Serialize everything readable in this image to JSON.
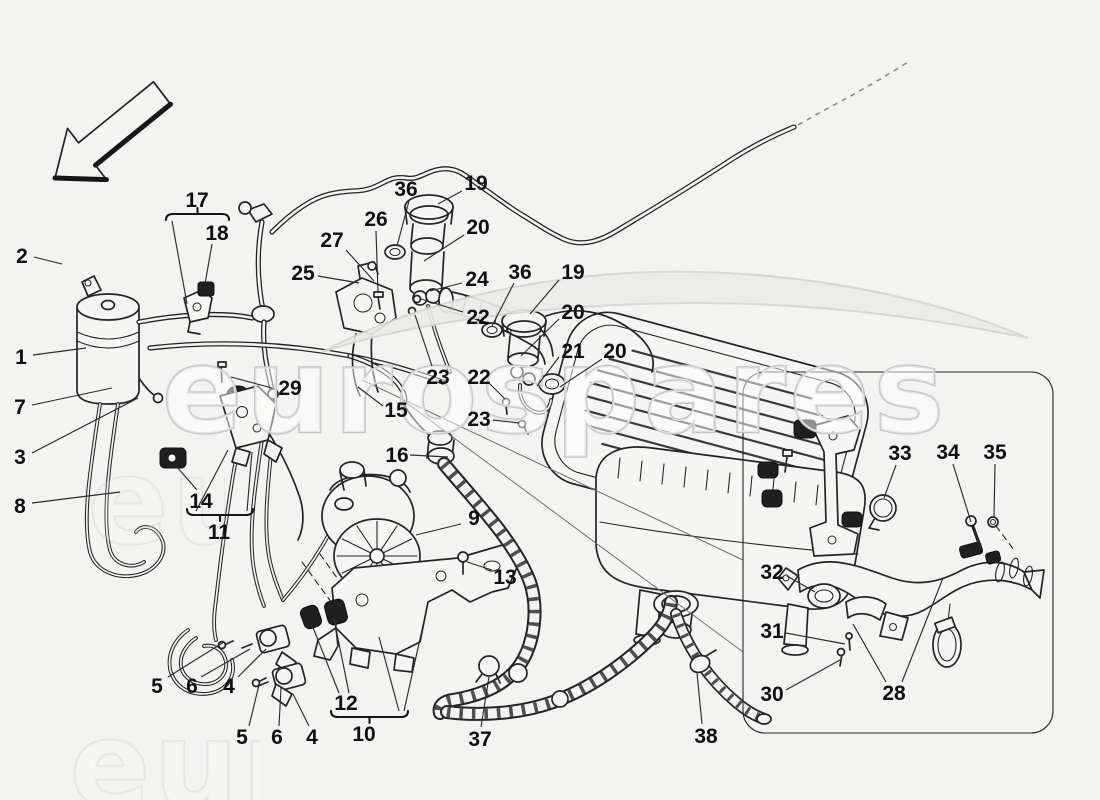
{
  "canvas": {
    "width": 1100,
    "height": 800,
    "paper_color": "#f3f3f1",
    "line_color": "#242424",
    "label_color": "#101010"
  },
  "watermark": {
    "text": "eurospares",
    "outline_color": "#c6c6c6",
    "fill_color": "#ffffff",
    "swoosh_color": "#ececea"
  },
  "direction_arrow": {
    "present": true,
    "points_to": "front-left"
  },
  "inset_box": {
    "x": 743,
    "y": 372,
    "width": 310,
    "height": 361
  },
  "callouts": [
    {
      "n": "2",
      "x": 22,
      "y": 256,
      "leaders": [
        [
          34,
          257,
          62,
          264
        ]
      ]
    },
    {
      "n": "1",
      "x": 21,
      "y": 357,
      "leaders": [
        [
          33,
          355,
          86,
          348
        ]
      ]
    },
    {
      "n": "7",
      "x": 20,
      "y": 407,
      "leaders": [
        [
          32,
          405,
          112,
          388
        ]
      ]
    },
    {
      "n": "3",
      "x": 20,
      "y": 457,
      "leaders": [
        [
          32,
          453,
          138,
          398
        ]
      ]
    },
    {
      "n": "8",
      "x": 20,
      "y": 506,
      "leaders": [
        [
          32,
          503,
          120,
          492
        ]
      ]
    },
    {
      "n": "17",
      "x": 197,
      "y": 200,
      "leaders": [
        [
          172,
          221,
          187,
          304
        ]
      ]
    },
    {
      "n": "18",
      "x": 217,
      "y": 233,
      "leaders": [
        [
          212,
          244,
          205,
          284
        ]
      ]
    },
    {
      "n": "29",
      "x": 290,
      "y": 388,
      "leaders": [
        [
          272,
          388,
          231,
          377
        ]
      ]
    },
    {
      "n": "14",
      "x": 201,
      "y": 501,
      "leaders": [
        [
          197,
          490,
          176,
          466
        ]
      ]
    },
    {
      "n": "11",
      "x": 219,
      "y": 532,
      "leaders": [
        [
          196,
          511,
          228,
          450
        ],
        [
          247,
          511,
          252,
          452
        ]
      ]
    },
    {
      "n": "5",
      "x": 157,
      "y": 686,
      "leaders": [
        [
          168,
          677,
          224,
          642
        ]
      ]
    },
    {
      "n": "6",
      "x": 192,
      "y": 686,
      "leaders": [
        [
          201,
          677,
          250,
          649
        ]
      ]
    },
    {
      "n": "4",
      "x": 229,
      "y": 686,
      "leaders": [
        [
          238,
          677,
          266,
          649
        ]
      ]
    },
    {
      "n": "5",
      "x": 242,
      "y": 737,
      "leaders": [
        [
          249,
          726,
          259,
          685
        ]
      ]
    },
    {
      "n": "6",
      "x": 277,
      "y": 737,
      "leaders": [
        [
          279,
          726,
          281,
          688
        ]
      ]
    },
    {
      "n": "4",
      "x": 312,
      "y": 737,
      "leaders": [
        [
          309,
          726,
          293,
          694
        ]
      ]
    },
    {
      "n": "12",
      "x": 346,
      "y": 703,
      "leaders": [
        [
          339,
          693,
          312,
          625
        ],
        [
          349,
          693,
          334,
          619
        ]
      ]
    },
    {
      "n": "10",
      "x": 364,
      "y": 734,
      "leaders": [
        [
          399,
          711,
          379,
          637
        ],
        [
          404,
          711,
          424,
          621
        ]
      ]
    },
    {
      "n": "15",
      "x": 396,
      "y": 410,
      "leaders": [
        [
          383,
          406,
          358,
          387
        ]
      ]
    },
    {
      "n": "16",
      "x": 397,
      "y": 455,
      "leaders": [
        [
          410,
          455,
          448,
          457
        ]
      ]
    },
    {
      "n": "9",
      "x": 474,
      "y": 518,
      "leaders": [
        [
          461,
          524,
          416,
          535
        ]
      ]
    },
    {
      "n": "13",
      "x": 505,
      "y": 577,
      "leaders": [
        [
          492,
          570,
          467,
          562
        ]
      ]
    },
    {
      "n": "37",
      "x": 480,
      "y": 739,
      "leaders": [
        [
          481,
          727,
          489,
          677
        ]
      ]
    },
    {
      "n": "38",
      "x": 706,
      "y": 736,
      "leaders": [
        [
          702,
          724,
          697,
          673
        ]
      ]
    },
    {
      "n": "26",
      "x": 376,
      "y": 219,
      "leaders": [
        [
          376,
          231,
          378,
          292
        ]
      ]
    },
    {
      "n": "36",
      "x": 406,
      "y": 189,
      "leaders": [
        [
          409,
          201,
          397,
          246
        ]
      ]
    },
    {
      "n": "19",
      "x": 476,
      "y": 183,
      "leaders": [
        [
          462,
          191,
          438,
          204
        ]
      ]
    },
    {
      "n": "20",
      "x": 478,
      "y": 227,
      "leaders": [
        [
          464,
          235,
          424,
          261
        ]
      ]
    },
    {
      "n": "27",
      "x": 332,
      "y": 240,
      "leaders": [
        [
          346,
          250,
          374,
          281
        ]
      ]
    },
    {
      "n": "25",
      "x": 303,
      "y": 273,
      "leaders": [
        [
          318,
          276,
          359,
          283
        ]
      ]
    },
    {
      "n": "24",
      "x": 477,
      "y": 279,
      "leaders": [
        [
          462,
          283,
          430,
          291
        ]
      ]
    },
    {
      "n": "22",
      "x": 478,
      "y": 317,
      "leaders": [
        [
          463,
          312,
          421,
          299
        ]
      ]
    },
    {
      "n": "36",
      "x": 520,
      "y": 272,
      "leaders": [
        [
          514,
          283,
          492,
          326
        ]
      ]
    },
    {
      "n": "19",
      "x": 573,
      "y": 272,
      "leaders": [
        [
          559,
          280,
          530,
          314
        ]
      ]
    },
    {
      "n": "20",
      "x": 573,
      "y": 312,
      "leaders": [
        [
          559,
          319,
          521,
          356
        ]
      ]
    },
    {
      "n": "21",
      "x": 573,
      "y": 351,
      "leaders": [
        [
          559,
          357,
          537,
          386
        ]
      ]
    },
    {
      "n": "20",
      "x": 615,
      "y": 351,
      "leaders": [
        [
          602,
          359,
          560,
          387
        ]
      ]
    },
    {
      "n": "23",
      "x": 438,
      "y": 377,
      "leaders": [
        [
          432,
          366,
          415,
          315
        ]
      ]
    },
    {
      "n": "22",
      "x": 479,
      "y": 377,
      "leaders": [
        [
          490,
          384,
          505,
          399
        ]
      ]
    },
    {
      "n": "23",
      "x": 479,
      "y": 419,
      "leaders": [
        [
          493,
          420,
          519,
          423
        ]
      ]
    },
    {
      "n": "33",
      "x": 900,
      "y": 453,
      "leaders": [
        [
          896,
          465,
          884,
          498
        ]
      ]
    },
    {
      "n": "34",
      "x": 948,
      "y": 452,
      "leaders": [
        [
          953,
          464,
          971,
          522
        ]
      ]
    },
    {
      "n": "35",
      "x": 995,
      "y": 452,
      "leaders": [
        [
          995,
          464,
          994,
          516
        ]
      ]
    },
    {
      "n": "32",
      "x": 772,
      "y": 572,
      "leaders": [
        [
          787,
          576,
          815,
          592
        ]
      ]
    },
    {
      "n": "31",
      "x": 772,
      "y": 631,
      "leaders": [
        [
          786,
          633,
          845,
          644
        ]
      ]
    },
    {
      "n": "30",
      "x": 772,
      "y": 694,
      "leaders": [
        [
          786,
          690,
          840,
          660
        ]
      ]
    },
    {
      "n": "28",
      "x": 894,
      "y": 693,
      "leaders": [
        [
          886,
          682,
          853,
          624
        ],
        [
          902,
          682,
          943,
          578
        ]
      ]
    }
  ],
  "braces": [
    {
      "x1": 166,
      "x2": 229,
      "y": 214,
      "tick": "up",
      "for": "17"
    },
    {
      "x1": 187,
      "x2": 253,
      "y": 515,
      "tick": "down",
      "for": "11"
    },
    {
      "x1": 331,
      "x2": 408,
      "y": 717,
      "tick": "down",
      "for": "10"
    }
  ]
}
